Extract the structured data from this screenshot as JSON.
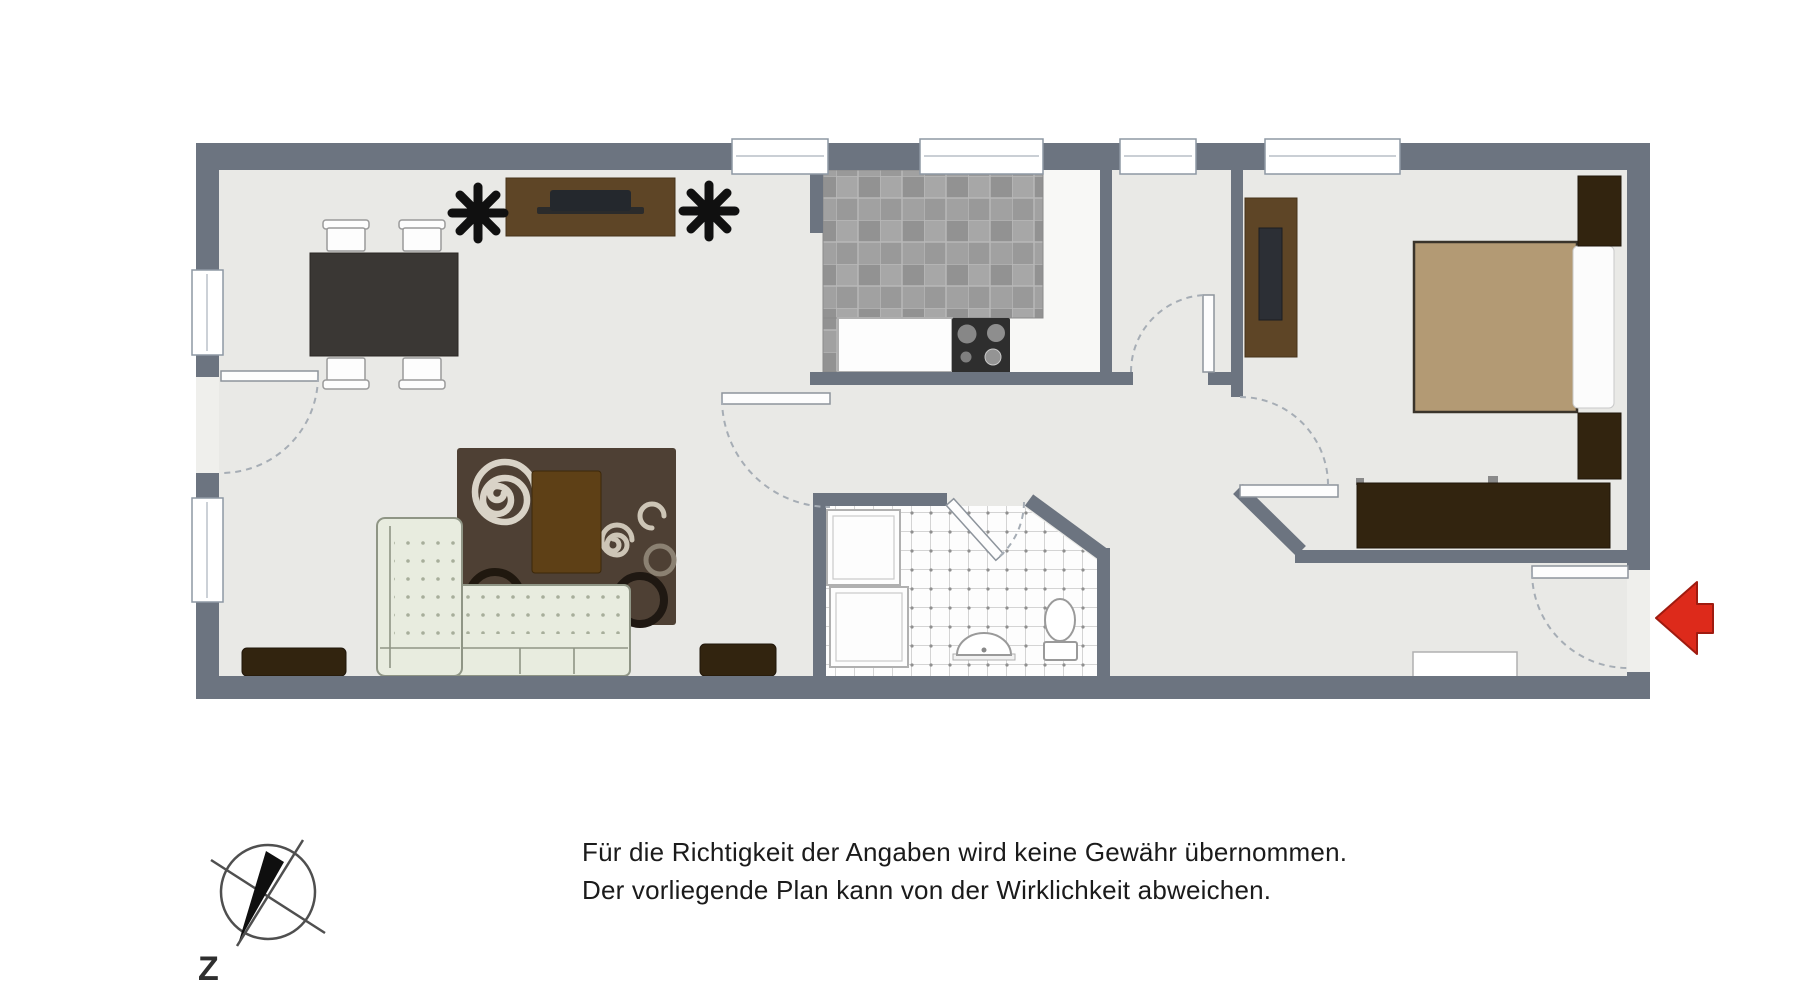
{
  "disclaimer": {
    "line1": "Für die Richtigkeit der Angaben wird keine Gewähr übernommen.",
    "line2": "Der vorliegende Plan kann von der Wirklichkeit abweichen."
  },
  "compass": {
    "label": "Z"
  },
  "colors": {
    "wall": "#6c7480",
    "floor": "#e9e9e6",
    "kitchen_floor": "#f8f8f6",
    "bathroom_floor": "#fdfdfd",
    "kitchen_tile_dark": "#8f8f8f",
    "kitchen_tile_light": "#a9a9a9",
    "rug": "#4e4034",
    "rug_spiral": "#d9d3c7",
    "sofa": "#e8ecdf",
    "dark_wood": "#32240f",
    "mid_wood": "#5e4526",
    "dining_table": "#3a3734",
    "bed_duvet": "#b39a74",
    "arrow_red": "#dd2a1b"
  }
}
